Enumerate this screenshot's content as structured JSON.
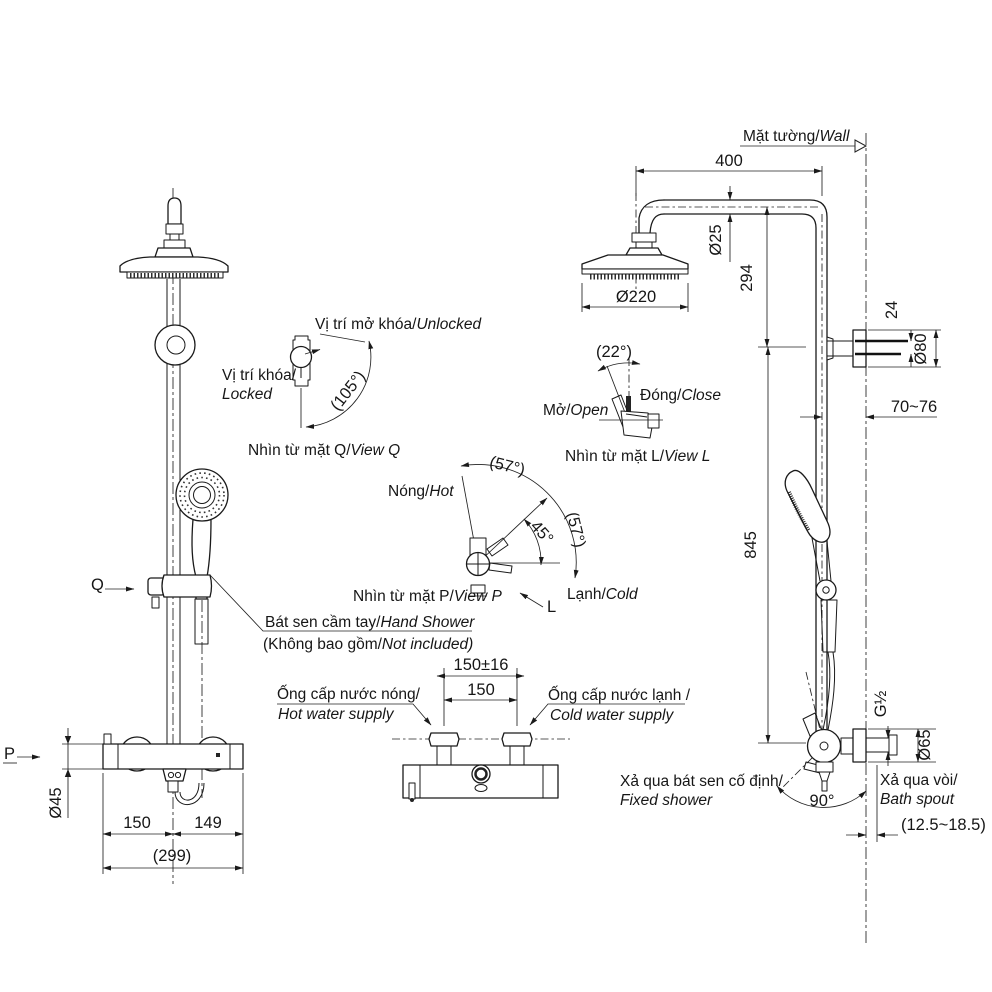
{
  "meta": {
    "type": "technical-drawing",
    "subject": "Shower column installation dimension drawing",
    "line_color": "#1a1a1a",
    "background": "#ffffff"
  },
  "labels": {
    "wall": {
      "vi": "Mặt tường/",
      "en": "Wall"
    },
    "hand_shower": {
      "vi": "Bát sen cầm tay/",
      "en": "Hand Shower"
    },
    "not_included": {
      "vi": "(Không bao gồm/",
      "en": "Not included)"
    },
    "hot_supply": {
      "vi": "Ống cấp nước nóng/",
      "en": "Hot water supply"
    },
    "cold_supply": {
      "vi": "Ống cấp nước lạnh /",
      "en": "Cold water supply"
    },
    "fixed_shower": {
      "vi": "Xả qua bát sen cố định/",
      "en": "Fixed shower"
    },
    "bath_spout": {
      "vi": "Xả qua vòi/",
      "en": "Bath spout"
    }
  },
  "views": {
    "q": {
      "caption_vi": "Nhìn từ mặt Q/",
      "caption_en": "View Q",
      "unlocked_vi": "Vị trí mở khóa/",
      "unlocked_en": "Unlocked",
      "locked_vi": "Vị trí khóa/",
      "locked_en": "Locked",
      "angle": "(105°)",
      "letter": "Q"
    },
    "l": {
      "caption_vi": "Nhìn từ mặt L/",
      "caption_en": "View L",
      "open_vi": "Mở/",
      "open_en": "Open",
      "close_vi": "Đóng/",
      "close_en": "Close",
      "angle": "(22°)",
      "letter": "L"
    },
    "p": {
      "caption_vi": "Nhìn từ mặt P/",
      "caption_en": "View P",
      "hot_vi": "Nóng/",
      "hot_en": "Hot",
      "cold_vi": "Lạnh/",
      "cold_en": "Cold",
      "angle_upper": "(57°)",
      "angle_lower": "(57°)",
      "angle_mid": "45°",
      "letter": "P"
    }
  },
  "dimensions": {
    "arm_length": "400",
    "arm_pipe_dia": "Ø25",
    "head_drop": "294",
    "head_dia": "Ø220",
    "screw_spacing": "24",
    "bracket_dia": "Ø80",
    "wall_clearance": "70~76",
    "column_length": "845",
    "thread_size": "G½",
    "flange_dia": "Ø65",
    "swivel_angle": "90°",
    "spout_projection": "(12.5~18.5)",
    "inlet_spacing_tol": "150±16",
    "inlet_spacing": "150",
    "center_left": "150",
    "center_right": "149",
    "overall_width": "(299)",
    "valve_body_dia": "Ø45"
  }
}
